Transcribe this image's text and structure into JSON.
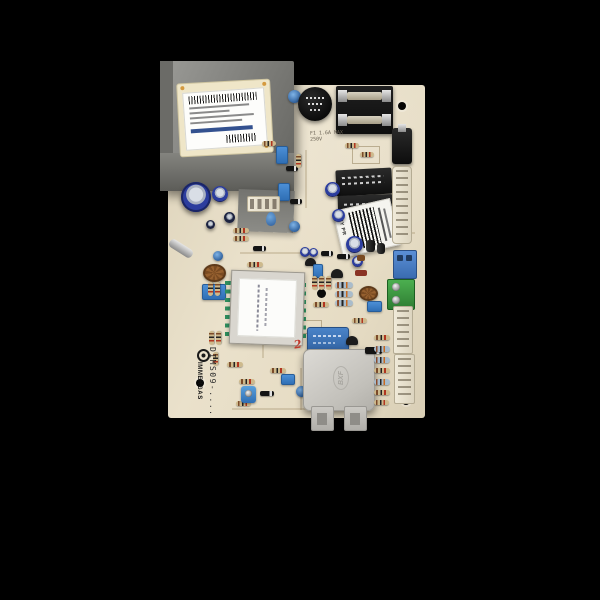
{
  "meta": {
    "description": "Photograph of a beige electronic boiler control PCB (Immergas DIMS09 mainboard) centered on a solid black background"
  },
  "board": {
    "brand": "IMMERGAS",
    "model": "DIMS09-....",
    "fuse_silkscreen_line1": "F1 1.6A MAX",
    "fuse_silkscreen_line2": "250V",
    "bxf_marking": "BXF",
    "warranty_sticker_text": "NTY PR",
    "handwritten_mark": "2"
  }
}
